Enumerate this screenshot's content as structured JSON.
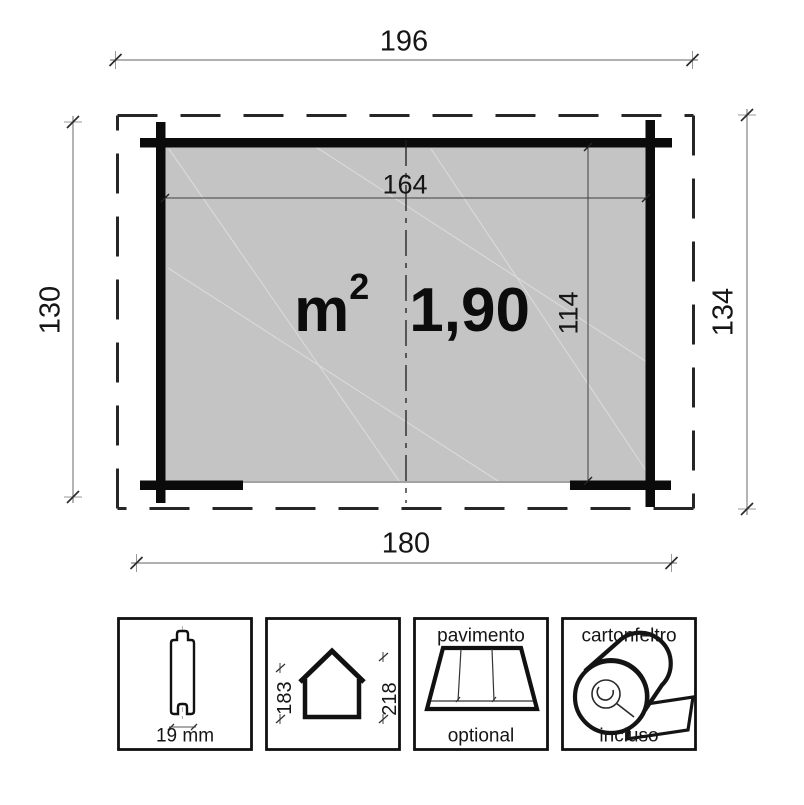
{
  "plan": {
    "dim_roof_width": "196",
    "dim_inner_width": "164",
    "dim_depth_left": "130",
    "dim_depth_right": "134",
    "dim_inner_depth": "114",
    "dim_wall_width": "180",
    "area_unit": "m",
    "area_exponent": "2",
    "area_value": "1,90"
  },
  "legend": {
    "plank": {
      "thickness": "19 mm"
    },
    "house": {
      "eave_height": "183",
      "ridge_height": "218"
    },
    "floor": {
      "title": "pavimento",
      "note": "optional"
    },
    "felt": {
      "title": "cartonfeltro",
      "note": "incluso"
    }
  },
  "colors": {
    "floor_fill": "#c4c4c4",
    "wall": "#0b0b0b",
    "dim_line": "#828282",
    "text": "#161616"
  }
}
